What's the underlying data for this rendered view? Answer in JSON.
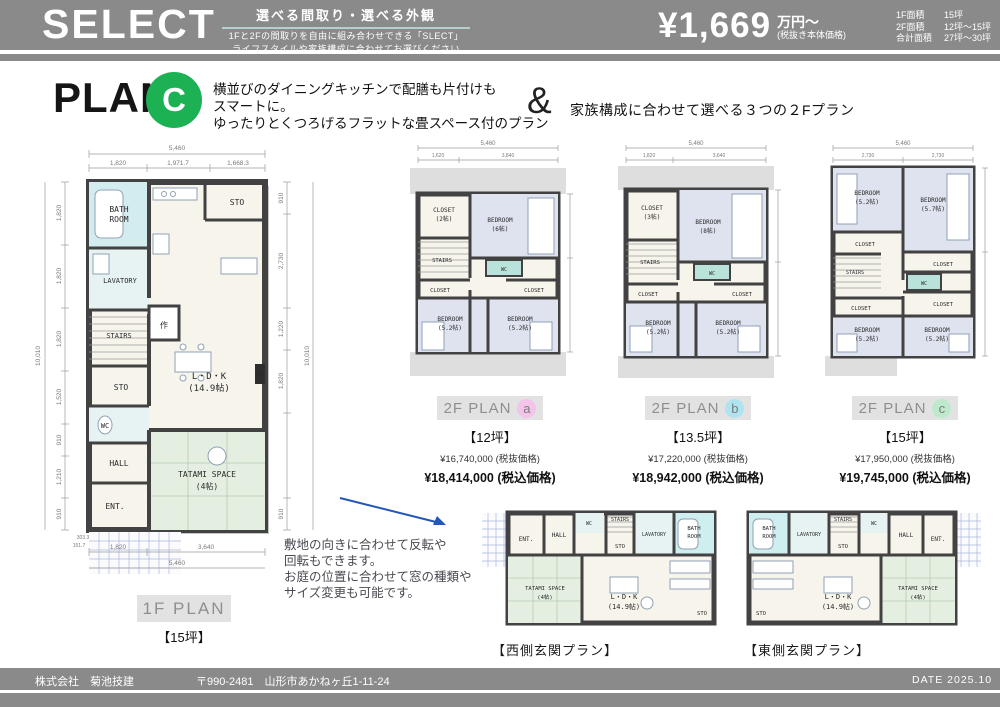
{
  "header": {
    "brand": "SELECT",
    "tagline_title": "選べる間取り・選べる外観",
    "tagline_l1": "1Fと2Fの間取りを自由に組み合わせできる「SLECT」",
    "tagline_l2": "ライフスタイルや家族構成に合わせてお選びください",
    "price": "¥1,669",
    "price_unit": "万円～",
    "price_note": "(税抜き本体価格)",
    "areas": [
      {
        "label": "1F面積",
        "value": "15坪"
      },
      {
        "label": "2F面積",
        "value": "12坪～15坪"
      },
      {
        "label": "合計面積",
        "value": "27坪～30坪"
      }
    ]
  },
  "ph": {
    "title": "PLAN",
    "letter": "C",
    "d1": "横並びのダイニングキッチンで配膳も片付けも",
    "d2": "スマートに。",
    "d3": "ゆったりとくつろげるフラットな畳スペース付のプラン",
    "amp": "&",
    "and_text": "家族構成に合わせて選べる３つの２Fプラン"
  },
  "rm": {
    "bath1": "BATH",
    "bath2": "ROOM",
    "lav": "LAVATORY",
    "stairs": "STAIRS",
    "sto": "STO",
    "wc": "WC",
    "hall": "HALL",
    "ent": "ENT.",
    "ldk1": "L・D・K",
    "ldk2": "(14.9帖)",
    "tat1": "TATAMI SPACE",
    "tat2": "(4帖)",
    "clo": "CLOSET",
    "clo2": "(2帖)",
    "clo3": "(3帖)",
    "bed": "BEDROOM",
    "s6": "(6帖)",
    "s8": "(8帖)",
    "s52": "(5.2帖)",
    "s57": "(5.7帖)",
    "ps": "PS",
    "saku": "作"
  },
  "f1": {
    "label": "1F PLAN",
    "size": "【15坪】",
    "dims": {
      "top_total": "5,460",
      "top": [
        "1,820",
        "1,971.7",
        "1,668.3"
      ],
      "left_total": "10,010",
      "left": [
        "1,820",
        "1,820",
        "1,820",
        "1,520",
        "910",
        "1,210",
        "910"
      ],
      "right": [
        "910",
        "2,730",
        "1,220",
        "1,820",
        "910"
      ],
      "right_total": "10,010",
      "bottom": [
        "1,820",
        "3,640"
      ],
      "bottom_total": "5,460",
      "tiny_a": "303.3",
      "tiny_b": "151.7"
    }
  },
  "f2a": {
    "label": "2F PLAN",
    "letter": "a",
    "size": "【12坪】",
    "price_ex": "¥16,740,000 (税抜価格)",
    "price_in": "¥18,414,000 (税込価格)",
    "dims": {
      "top_total": "5,460",
      "top": [
        "1,620",
        "3,840"
      ]
    }
  },
  "f2b": {
    "label": "2F PLAN",
    "letter": "b",
    "size": "【13.5坪】",
    "price_ex": "¥17,220,000 (税抜価格)",
    "price_in": "¥18,942,000 (税込価格)",
    "dims": {
      "top_total": "5,460",
      "top": [
        "1,820",
        "3,640"
      ]
    }
  },
  "f2c": {
    "label": "2F PLAN",
    "letter": "c",
    "size": "【15坪】",
    "price_ex": "¥17,950,000 (税抜価格)",
    "price_in": "¥19,745,000 (税込価格)",
    "dims": {
      "top_total": "5,460",
      "top": [
        "2,730",
        "2,730"
      ]
    }
  },
  "note": {
    "l1": "敷地の向きに合わせて反転や",
    "l2": "回転もできます。",
    "l3": "お庭の位置に合わせて窓の種類や",
    "l4": "サイズ変更も可能です。"
  },
  "bottom": {
    "west_label": "【西側玄関プラン】",
    "east_label": "【東側玄関プラン】"
  },
  "footer": {
    "company": "株式会社　菊池技建",
    "address": "〒990-2481　山形市あかねヶ丘1-11-24",
    "date": "DATE 2025.10"
  },
  "colors": {
    "band_gray": "#8a8a8a",
    "accent_green": "#1cb254",
    "circle_a": "#f3c3e8",
    "circle_b": "#aee4f0",
    "circle_c": "#bfe9cc",
    "arrow_blue": "#2257b8",
    "tatami_green": "#e4efe1",
    "bath_cyan": "#d3ecef",
    "bedroom_blue": "#dee3ef",
    "wall_dark": "#424242"
  }
}
